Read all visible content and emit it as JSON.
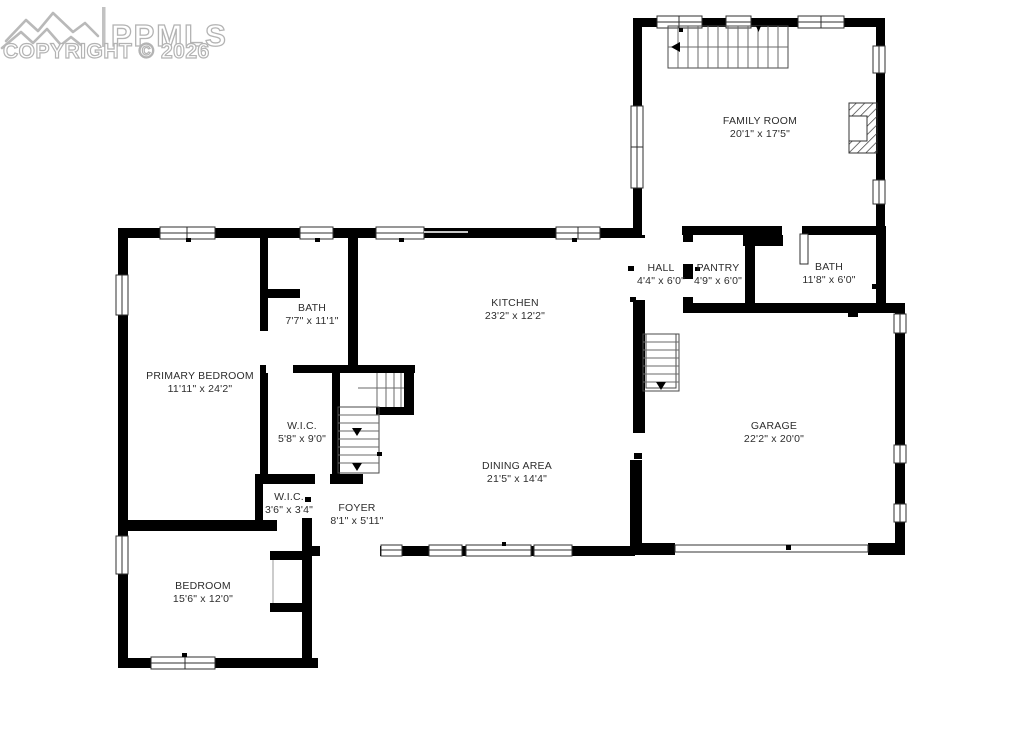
{
  "watermark": {
    "brand": "PPMLS",
    "copyright": "COPYRIGHT © 2026"
  },
  "rooms": [
    {
      "id": "family-room",
      "name": "FAMILY ROOM",
      "dims": "20'1\" x 17'5\"",
      "cx": 760,
      "cy": 124
    },
    {
      "id": "hall",
      "name": "HALL",
      "dims": "4'4\" x 6'0\"",
      "cx": 661,
      "cy": 271
    },
    {
      "id": "pantry",
      "name": "PANTRY",
      "dims": "4'9\" x 6'0\"",
      "cx": 718,
      "cy": 271
    },
    {
      "id": "bath-hall",
      "name": "BATH",
      "dims": "11'8\" x 6'0\"",
      "cx": 829,
      "cy": 270
    },
    {
      "id": "kitchen",
      "name": "KITCHEN",
      "dims": "23'2\" x 12'2\"",
      "cx": 515,
      "cy": 306
    },
    {
      "id": "primary-bath",
      "name": "BATH",
      "dims": "7'7\" x 11'1\"",
      "cx": 312,
      "cy": 311
    },
    {
      "id": "primary-bedroom",
      "name": "PRIMARY BEDROOM",
      "dims": "11'11\" x 24'2\"",
      "cx": 200,
      "cy": 379
    },
    {
      "id": "wic-large",
      "name": "W.I.C.",
      "dims": "5'8\" x 9'0\"",
      "cx": 302,
      "cy": 429
    },
    {
      "id": "wic-small",
      "name": "W.I.C.",
      "dims": "3'6\" x 3'4\"",
      "cx": 289,
      "cy": 500
    },
    {
      "id": "foyer",
      "name": "FOYER",
      "dims": "8'1\" x 5'11\"",
      "cx": 357,
      "cy": 511
    },
    {
      "id": "dining-area",
      "name": "DINING AREA",
      "dims": "21'5\" x 14'4\"",
      "cx": 517,
      "cy": 469
    },
    {
      "id": "garage",
      "name": "GARAGE",
      "dims": "22'2\" x 20'0\"",
      "cx": 774,
      "cy": 429
    },
    {
      "id": "bedroom",
      "name": "BEDROOM",
      "dims": "15'6\" x 12'0\"",
      "cx": 203,
      "cy": 589
    }
  ],
  "features": [
    "family-room-stairs",
    "central-stairs",
    "basement-stairs",
    "fireplace",
    "garage-door",
    "front-entry-opening"
  ],
  "colors": {
    "wall": "#000000",
    "background": "#ffffff",
    "label": "#2d2d2d",
    "watermark": "#b9b9b9"
  }
}
